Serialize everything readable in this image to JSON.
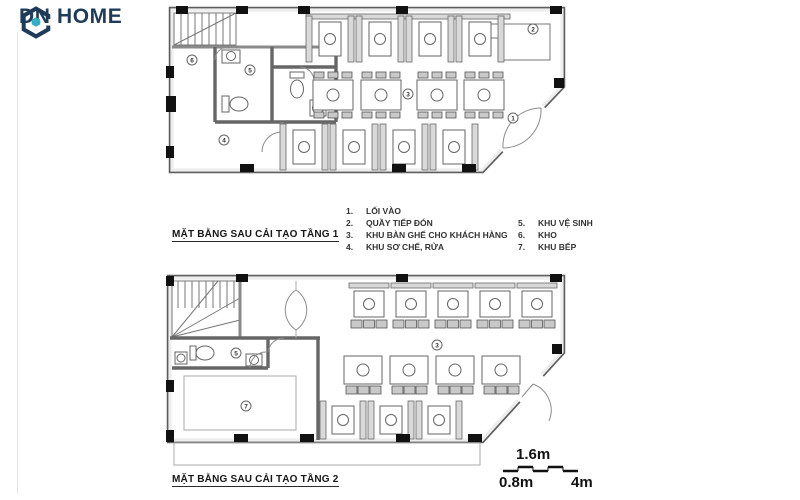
{
  "logo": {
    "text": "DN HOME",
    "brand_color": "#1e3c59",
    "accent_color": "#35aec4"
  },
  "floor1": {
    "title": "MẶT BẰNG SAU CẢI TẠO TẦNG 1"
  },
  "floor2": {
    "title": "MẶT BẰNG SAU CẢI TẠO TẦNG 2"
  },
  "legend": {
    "left_items": [
      {
        "num": "1.",
        "label": "LỐI VÀO"
      },
      {
        "num": "2.",
        "label": "QUẦY TIẾP ĐÓN"
      },
      {
        "num": "3.",
        "label": "KHU BÀN GHẾ CHO KHÁCH HÀNG"
      },
      {
        "num": "4.",
        "label": "KHU SƠ CHẾ, RỬA"
      }
    ],
    "right_items": [
      {
        "num": "5.",
        "label": "KHU VỆ SINH"
      },
      {
        "num": "6.",
        "label": "KHO"
      },
      {
        "num": "7.",
        "label": "KHU BẾP"
      }
    ]
  },
  "scale_bar": {
    "top_label": "1.6m",
    "bottom_left_label": "0.8m",
    "bottom_right_label": "4m"
  },
  "plan_labels": {
    "f1_entrance": "1",
    "f1_counter": "2",
    "f1_dining": "3",
    "f1_prep": "4",
    "f1_wc": "5",
    "f1_storage": "6",
    "f2_dining": "3",
    "f2_wc": "5",
    "f2_kitchen": "7"
  }
}
